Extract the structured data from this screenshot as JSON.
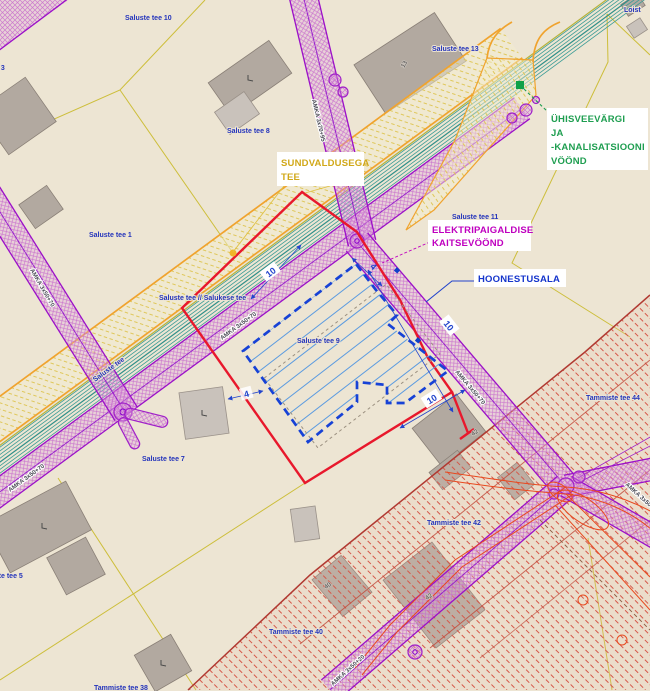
{
  "annotations": {
    "sundvaldusega_tee": {
      "lines": [
        "SUNDVALDUSEGA",
        "TEE"
      ],
      "color": "#D1A818"
    },
    "elektripaigaldise": {
      "lines": [
        "ELEKTRIPAIGALDISE",
        "KAITSEVÖÖND"
      ],
      "color": "#BF00BF"
    },
    "hoonestusala": {
      "label": "HOONESTUSALA",
      "color": "#1535CC"
    },
    "uhisveevargi": {
      "lines": [
        "ÜHISVEEVÄRGI",
        "JA",
        "-KANALISATSIOONI",
        "VÖÖND"
      ],
      "color": "#1E9E50"
    }
  },
  "parcel_labels": [
    {
      "t": "Saluste tee 10"
    },
    {
      "t": "Saluste tee 13"
    },
    {
      "t": "Saluste tee 8"
    },
    {
      "t": "Saluste tee 1"
    },
    {
      "t": "Saluste tee 11"
    },
    {
      "t": "Saluste tee // Salukese tee"
    },
    {
      "t": "Saluste tee 9"
    },
    {
      "t": "Saluste tee 7"
    },
    {
      "t": "Saluste tee 5"
    },
    {
      "t": "Saluste tee 3"
    },
    {
      "t": "Tammiste tee 44"
    },
    {
      "t": "Tammiste tee 42"
    },
    {
      "t": "Tammiste tee 40"
    },
    {
      "t": "Tammiste tee 38"
    },
    {
      "t": "Loist"
    }
  ],
  "road_labels": [
    {
      "t": "Saluste tee"
    }
  ],
  "corridor_labels": [
    {
      "t": "AMKA 3x70+95"
    },
    {
      "t": "AMKA 3x50+70"
    },
    {
      "t": "AMKA 3x50+70"
    },
    {
      "t": "AMKA 3x50+70"
    },
    {
      "t": "AMKA 3x50+70"
    },
    {
      "t": "AMKA 3x50+20"
    },
    {
      "t": "AMKA 3x50+20"
    }
  ],
  "building_numbers": [
    {
      "t": "13"
    },
    {
      "t": "42"
    },
    {
      "t": "42"
    },
    {
      "t": "40"
    }
  ],
  "dimensions": {
    "ten": "10",
    "four": "4"
  },
  "colors": {
    "background": "#EDE5D3",
    "parcel_line": "#CDBE3A",
    "road_edge_orange": "#F0A32E",
    "water_sewer_teal": "#3C9C96",
    "electric_purple": "#A020C8",
    "sundvaldus_red": "#E8182C",
    "hoonestus_blue": "#1742D6",
    "restriction_red": "#C04838",
    "label_blue": "#2333BB"
  }
}
